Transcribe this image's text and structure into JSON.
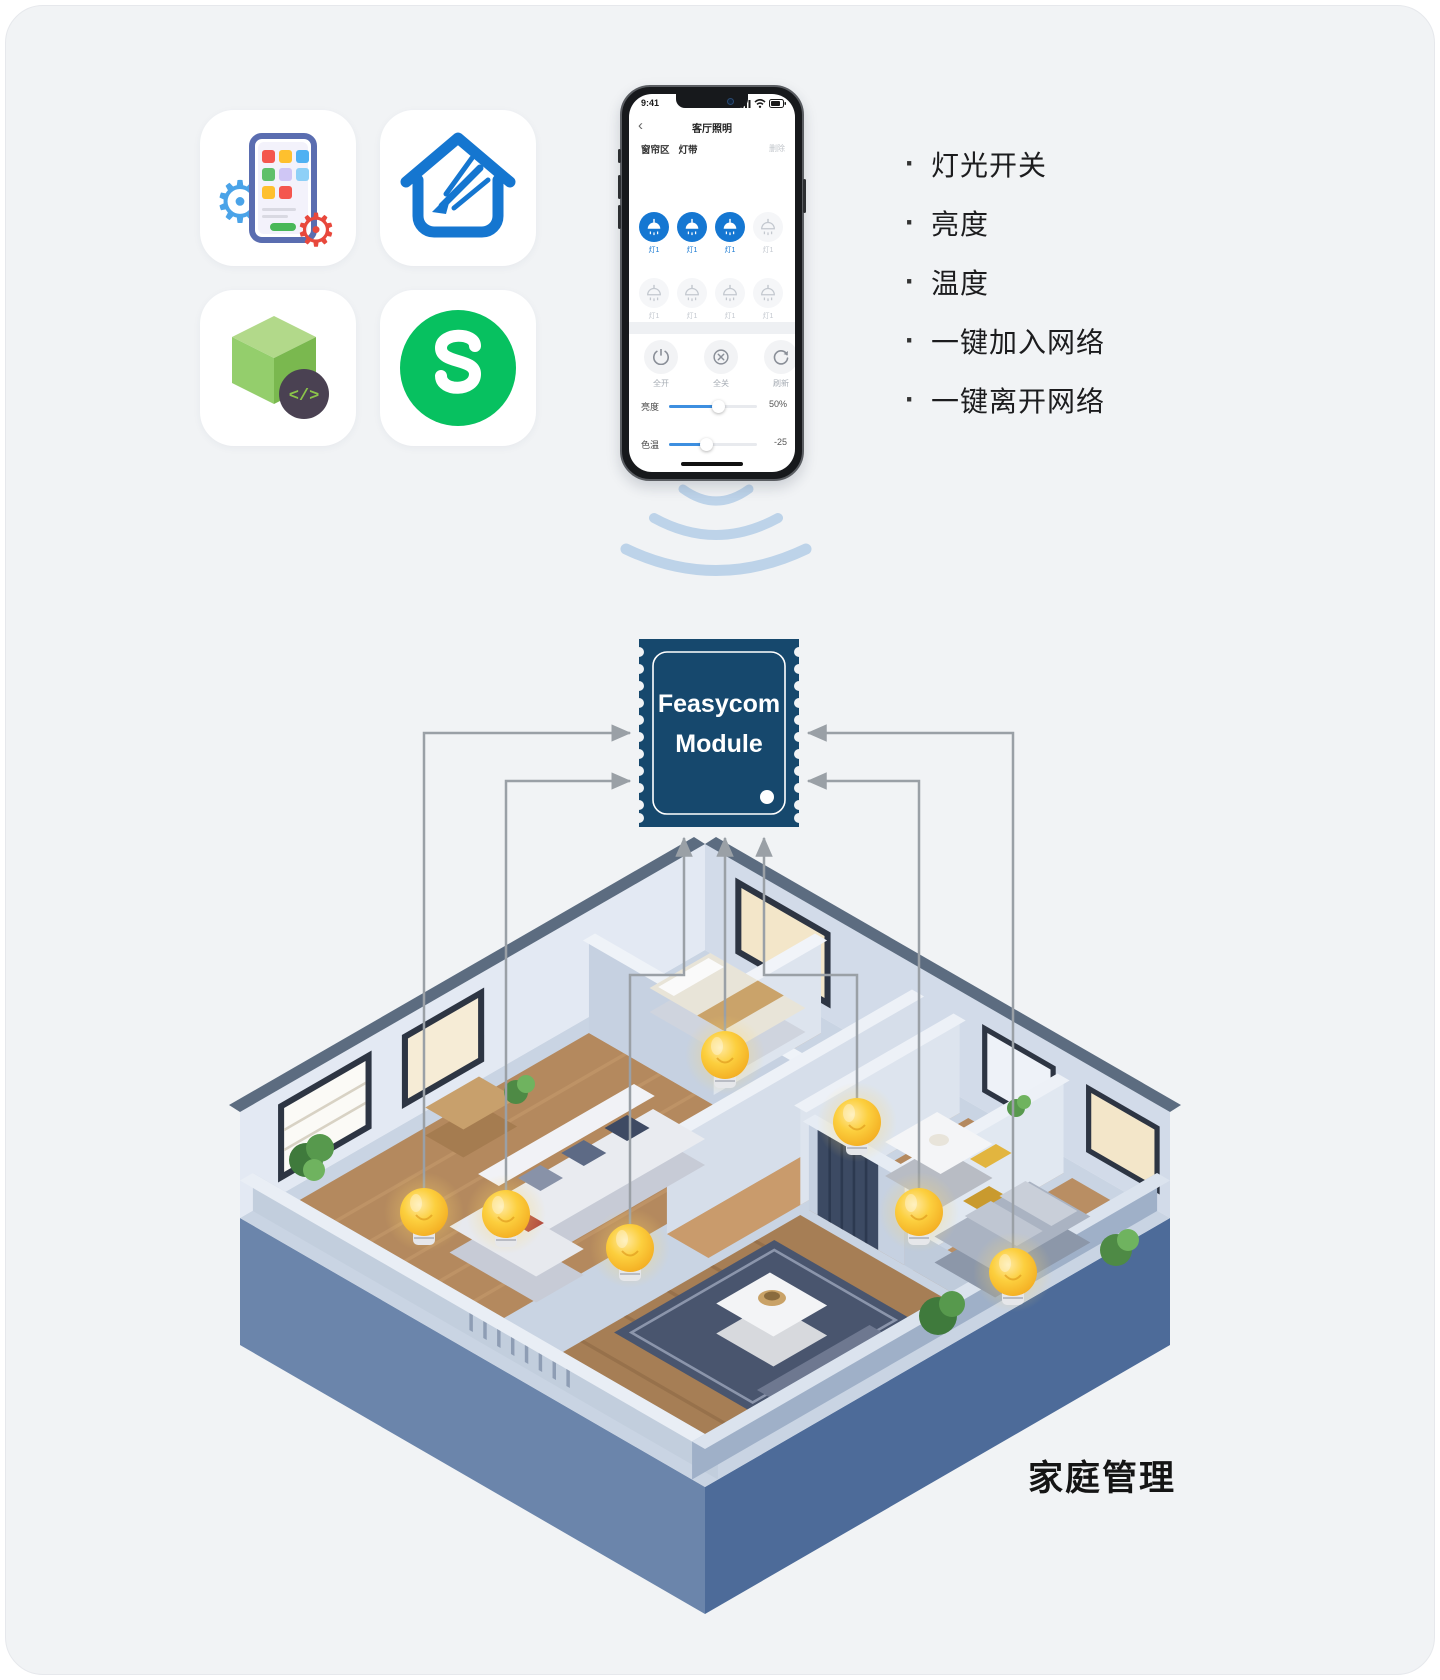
{
  "page": {
    "card_color": "#f1f3f5"
  },
  "app_icons": {
    "items": [
      {
        "name": "app-development-icon"
      },
      {
        "name": "smart-home-icon"
      },
      {
        "name": "sdk-cube-icon",
        "badge_text": "</>"
      },
      {
        "name": "wechat-mini-program-icon"
      }
    ]
  },
  "phone": {
    "status_time": "9:41",
    "back_icon": "‹",
    "nav_title": "客厅照明",
    "tabs": [
      {
        "label": "窗帘区"
      },
      {
        "label": "灯带"
      }
    ],
    "delete_label": "删除",
    "lamp_label": "灯1",
    "controls": [
      {
        "label": "全开",
        "icon": "power-icon"
      },
      {
        "label": "全关",
        "icon": "circle-x-icon"
      },
      {
        "label": "刷新",
        "icon": "refresh-icon"
      }
    ],
    "sliders": [
      {
        "label": "亮度",
        "value": "50%",
        "percent": 56
      },
      {
        "label": "色温",
        "value": "-25",
        "percent": 42
      }
    ]
  },
  "features": {
    "items": [
      "灯光开关",
      "亮度",
      "温度",
      "一键加入网络",
      "一键离开网络"
    ]
  },
  "module": {
    "line1": "Feasycom",
    "line2": "Module",
    "color": "#16486d"
  },
  "house": {
    "caption": "家庭管理",
    "bulb_count": 7
  },
  "colors": {
    "accent_blue": "#1577d2",
    "module_navy": "#16486d",
    "arrow_gray": "#9aa0a6",
    "wave_blue": "#bdd3e9",
    "wechat_green": "#07c160",
    "bulb_yellow": "#f9bez"
  }
}
